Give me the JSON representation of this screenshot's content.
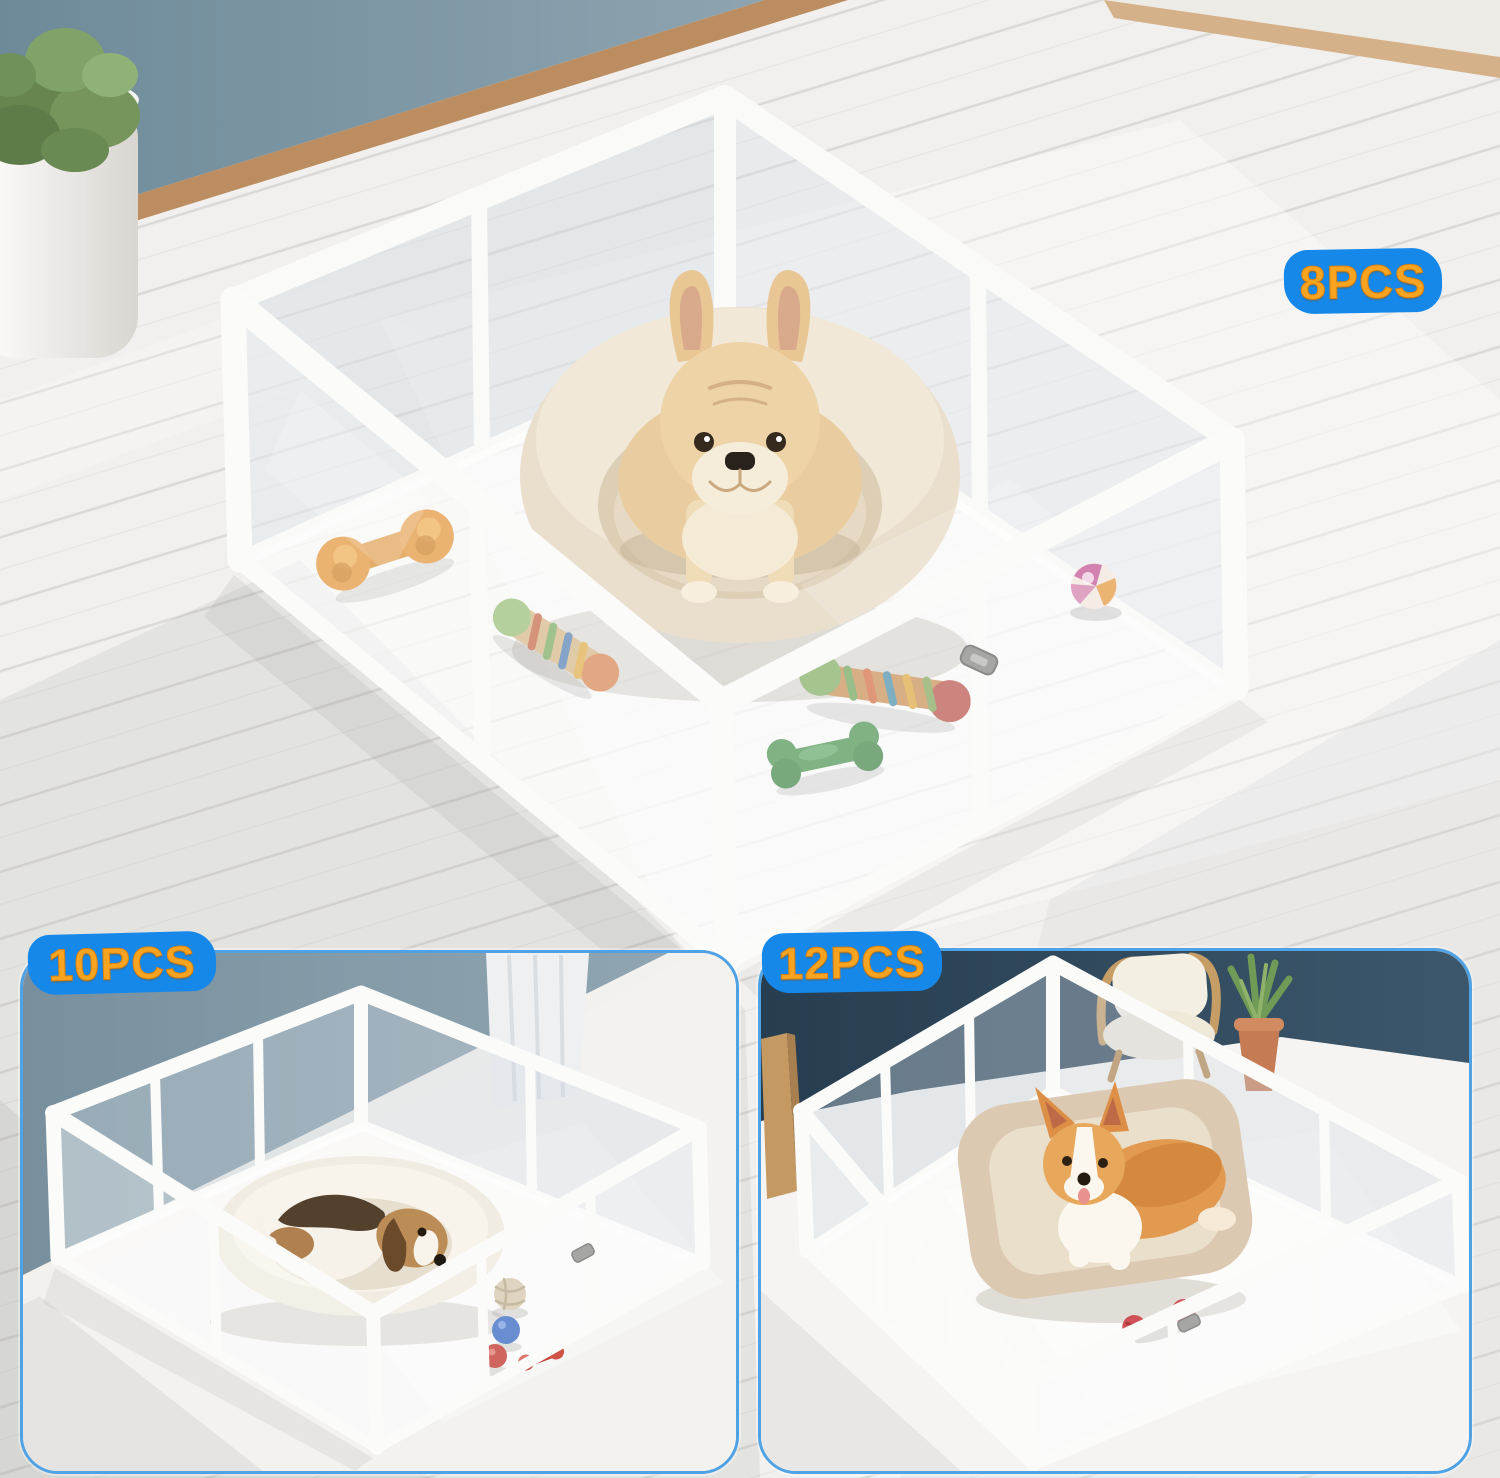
{
  "collage": {
    "badges": {
      "main": "8PCS",
      "bottom_left": "10PCS",
      "bottom_right": "12PCS"
    },
    "colors": {
      "badge_background": "#1588EA",
      "badge_text": "#F8A420",
      "inset_border": "#4FA3E4",
      "main_wall": "#7B929F",
      "left_inset_wall": "#7E95A3",
      "right_inset_wall": "#2C4357",
      "baseboard_wood": "#BE9064",
      "pen_frame": "#FAFAF8",
      "floor": "#F1F0EE",
      "donut_bed": "#E9DECE",
      "bolster_bed": "#DCC9B2"
    },
    "scenes": {
      "main": {
        "badge": "8PCS",
        "dog": "french-bulldog",
        "bed": "round-donut-bed",
        "toys": [
          "orange-dumbbell-chew",
          "multicolor-rope-knot",
          "multicolor-rope-bone",
          "green-rubber-bone",
          "pink-orange-swirl-ball"
        ]
      },
      "bottom_left": {
        "badge": "10PCS",
        "dog": "beagle",
        "bed": "round-donut-bed",
        "toys": [
          "rope-ball",
          "blue-ball",
          "red-ball",
          "red-chew-toy"
        ]
      },
      "bottom_right": {
        "badge": "12PCS",
        "dog": "corgi",
        "bed": "rectangular-bolster-bed",
        "toys": [
          "red-rope-dumbbell"
        ],
        "furniture": [
          "cream-armchair",
          "potted-snake-plant"
        ]
      }
    }
  }
}
